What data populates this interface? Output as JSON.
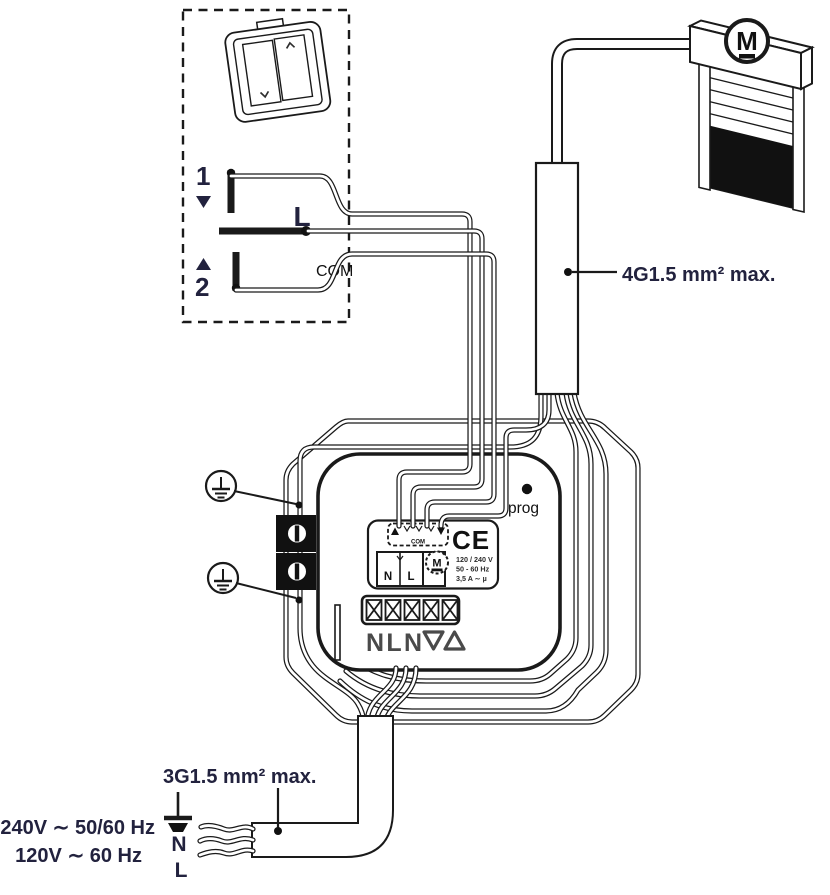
{
  "switch_area": {
    "terminal_1": "1",
    "terminal_2": "2",
    "live": "L",
    "common": "COM"
  },
  "labels": {
    "motor_cable": "4G1.5 mm² max.",
    "power_cable": "3G1.5 mm² max."
  },
  "supply": {
    "voltage_line_1": "240V ∼ 50/60 Hz",
    "voltage_line_2": "120V ∼ 60 Hz",
    "neutral": "N",
    "live": "L"
  },
  "module": {
    "prog_label": "prog",
    "ce_mark": "CE",
    "input_com": "COM",
    "neutral": "N",
    "live": "L",
    "motor_letter": "M",
    "ratings": [
      "120 / 240 V",
      "50 - 60 Hz",
      "3,5 A ∼ µ"
    ],
    "bottom_terminals": [
      "N",
      "L",
      "N"
    ]
  },
  "shutter": {
    "motor_letter": "M"
  },
  "colors": {
    "label_navy": "#22223e",
    "line_black": "#1a1a1a",
    "terminal_gray": "#4a4a4a"
  }
}
